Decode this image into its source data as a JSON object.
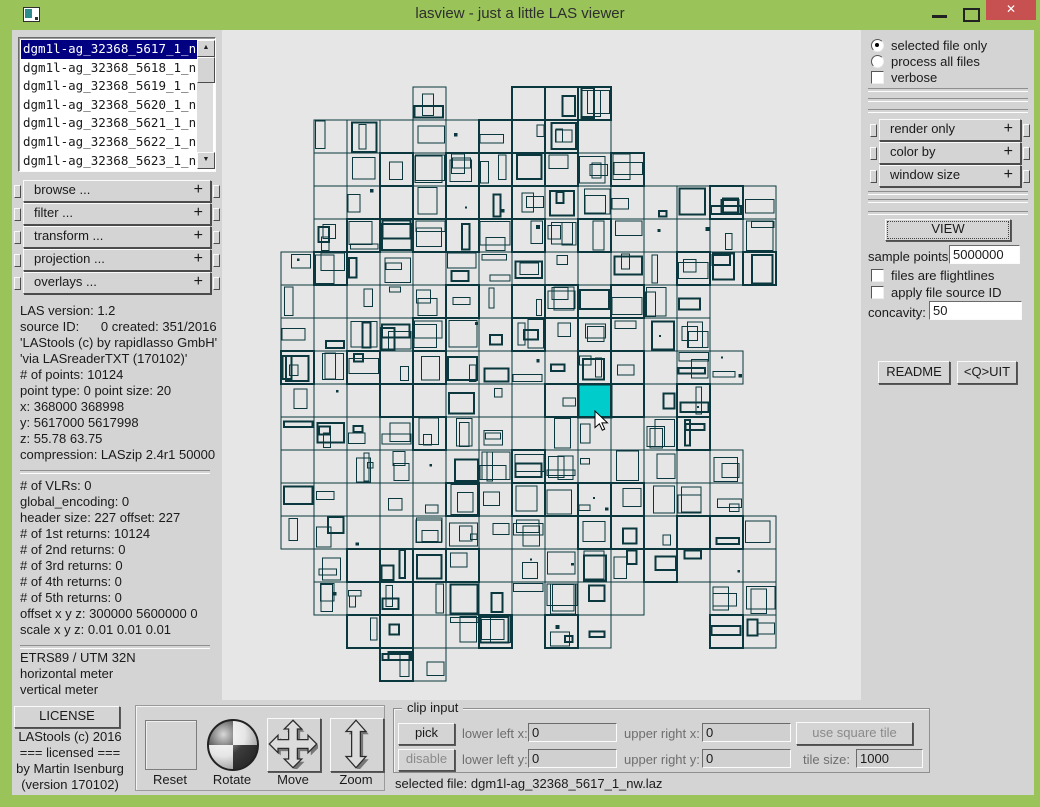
{
  "window": {
    "title": "lasview - just a little LAS viewer",
    "controls": {
      "minimize": "minimize",
      "maximize": "maximize",
      "close": "✕"
    }
  },
  "file_list": {
    "items": [
      "dgm1l-ag_32368_5617_1_n",
      "dgm1l-ag_32368_5618_1_n",
      "dgm1l-ag_32368_5619_1_n",
      "dgm1l-ag_32368_5620_1_n",
      "dgm1l-ag_32368_5621_1_n",
      "dgm1l-ag_32368_5622_1_n",
      "dgm1l-ag_32368_5623_1_n"
    ],
    "selected_index": 0
  },
  "accordion_plus": "+",
  "left_panel": {
    "accordion": [
      "browse ...",
      "filter ...",
      "transform ...",
      "projection ...",
      "overlays ..."
    ],
    "header_info": [
      "LAS version: 1.2",
      "source ID:      0 created: 351/2016",
      "'LAStools (c) by rapidlasso GmbH'",
      "'via LASreaderTXT (170102)'",
      "# of points: 10124",
      "point type: 0 point size: 20",
      "x: 368000 368998",
      "y: 5617000 5617998",
      "z: 55.78 63.75",
      "compression: LASzip 2.4r1 50000"
    ],
    "detail_info": [
      "# of VLRs: 0",
      "global_encoding: 0",
      "header size: 227 offset: 227",
      "# of 1st returns: 10124",
      "# of 2nd returns: 0",
      "# of 3rd returns: 0",
      "# of 4th returns: 0",
      "# of 5th returns: 0",
      "offset x y z: 300000 5600000 0",
      "scale x y z: 0.01 0.01 0.01"
    ],
    "crs_info": [
      "ETRS89 / UTM 32N",
      "horizontal meter",
      "vertical meter"
    ]
  },
  "right_panel": {
    "mode_options": [
      {
        "label": "selected file only",
        "selected": true
      },
      {
        "label": "process all files",
        "selected": false
      }
    ],
    "verbose_label": "verbose",
    "verbose_checked": false,
    "accordion": [
      "render only",
      "color by",
      "window size"
    ],
    "view_label": "VIEW",
    "sample_points": {
      "label": "sample points:",
      "value": "5000000"
    },
    "flightlines_label": "files are flightlines",
    "apply_source_label": "apply file source ID",
    "concavity": {
      "label": "concavity:",
      "value": "50"
    },
    "readme_label": "README",
    "quit_label": "<Q>UIT"
  },
  "bottom": {
    "license_label": "LICENSE",
    "credits": [
      "LAStools (c) 2016",
      "=== licensed ===",
      "by Martin Isenburg",
      "(version 170102)"
    ],
    "tools": [
      {
        "label": "Reset"
      },
      {
        "label": "Rotate"
      },
      {
        "label": "Move"
      },
      {
        "label": "Zoom"
      }
    ],
    "clip": {
      "legend": "clip input",
      "pick_label": "pick",
      "disable_label": "disable",
      "fields": [
        {
          "label": "lower left x:",
          "value": "0"
        },
        {
          "label": "lower left y:",
          "value": "0"
        },
        {
          "label": "upper right x:",
          "value": "0"
        },
        {
          "label": "upper right y:",
          "value": "0"
        }
      ],
      "use_square_label": "use square tile",
      "tile_size": {
        "label": "tile size:",
        "value": "1000"
      }
    },
    "selected_file": "selected file: dgm1l-ag_32368_5617_1_nw.laz"
  },
  "map": {
    "canvas_color": "#e6e6e6",
    "line_color": "#0a383e",
    "selected_fill": "#00cccc",
    "cell": 33,
    "origin_x": 59,
    "origin_y": 57,
    "seed": 1337,
    "selected_cell": {
      "col": 9,
      "row": 9
    },
    "cursor": {
      "x": 373,
      "y": 381
    },
    "rows": [
      {
        "r": 0,
        "cols": [
          [
            4,
            4
          ],
          [
            7,
            9
          ]
        ]
      },
      {
        "r": 1,
        "cols": [
          [
            1,
            9
          ]
        ]
      },
      {
        "r": 2,
        "cols": [
          [
            1,
            10
          ]
        ]
      },
      {
        "r": 3,
        "cols": [
          [
            1,
            14
          ]
        ]
      },
      {
        "r": 4,
        "cols": [
          [
            1,
            14
          ]
        ]
      },
      {
        "r": 5,
        "cols": [
          [
            0,
            14
          ]
        ]
      },
      {
        "r": 6,
        "cols": [
          [
            0,
            12
          ]
        ]
      },
      {
        "r": 7,
        "cols": [
          [
            0,
            12
          ]
        ]
      },
      {
        "r": 8,
        "cols": [
          [
            0,
            13
          ]
        ]
      },
      {
        "r": 9,
        "cols": [
          [
            0,
            12
          ]
        ]
      },
      {
        "r": 10,
        "cols": [
          [
            0,
            12
          ]
        ]
      },
      {
        "r": 11,
        "cols": [
          [
            0,
            13
          ]
        ]
      },
      {
        "r": 12,
        "cols": [
          [
            0,
            13
          ]
        ]
      },
      {
        "r": 13,
        "cols": [
          [
            0,
            14
          ]
        ]
      },
      {
        "r": 14,
        "cols": [
          [
            1,
            14
          ]
        ]
      },
      {
        "r": 15,
        "cols": [
          [
            1,
            10
          ],
          [
            13,
            14
          ]
        ]
      },
      {
        "r": 16,
        "cols": [
          [
            2,
            6
          ],
          [
            8,
            9
          ],
          [
            13,
            14
          ]
        ]
      },
      {
        "r": 17,
        "cols": [
          [
            3,
            4
          ]
        ]
      }
    ]
  }
}
